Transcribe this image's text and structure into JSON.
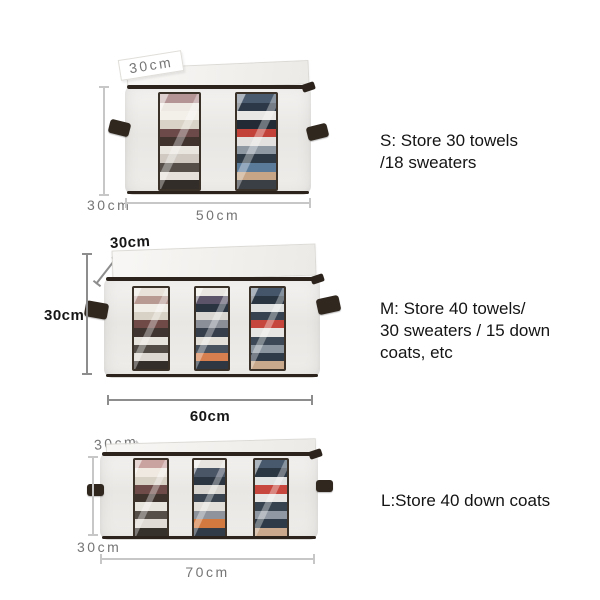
{
  "colors": {
    "canvas_bg": "#ffffff",
    "fabric": "#eceae7",
    "trim": "#2c241c",
    "handle": "#30271f",
    "window_frame": "#3a3128",
    "dim_light": "#c7c7c7",
    "dim_dark": "#8d8d8d",
    "label_gray": "#757575",
    "label_black": "#161616",
    "text": "#141414"
  },
  "products": [
    {
      "size": "S",
      "depth_label": "30cm",
      "height_label": "30cm",
      "width_label": "50cm",
      "description": "S: Store 30 towels\n/18 sweaters"
    },
    {
      "size": "M",
      "depth_label": "30cm",
      "height_label": "30cm",
      "width_label": "60cm",
      "description": "M: Store 40 towels/\n30 sweaters / 15 down\ncoats, etc"
    },
    {
      "size": "L",
      "depth_label": "30cm",
      "height_label": "30cm",
      "width_label": "70cm",
      "description": "L:Store 40 down coats"
    }
  ],
  "stripes": {
    "s1": [
      "#b59495",
      "#efe9e3",
      "#f3efe9",
      "#d9d2c6",
      "#6b4a49",
      "#40332e",
      "#e9e5df",
      "#cfc9c1",
      "#554e48",
      "#e5e0d9",
      "#332d29"
    ],
    "s2": [
      "#4a5a6e",
      "#2c3847",
      "#e8e7e5",
      "#222b35",
      "#c2423a",
      "#e2e1df",
      "#8f99a4",
      "#2e3a46",
      "#5b7b9b",
      "#c5a586",
      "#3a3f46"
    ],
    "m1": [
      "#e8e2da",
      "#b89a93",
      "#f0ece6",
      "#d8d1c5",
      "#6f4a47",
      "#3f3430",
      "#e6e2dc",
      "#524b45",
      "#ddd8d1",
      "#342e2a"
    ],
    "m2": [
      "#e9e6e1",
      "#5c5468",
      "#2a3340",
      "#d9d6d1",
      "#8a8f98",
      "#353e4a",
      "#e3e0da",
      "#47525e",
      "#d77f4f",
      "#2e3742"
    ],
    "m3": [
      "#45566b",
      "#2a3542",
      "#dfe0e0",
      "#36424f",
      "#c6453c",
      "#e6e5e3",
      "#3c4855",
      "#8b959f",
      "#2f3b48",
      "#c9a98b"
    ],
    "l1": [
      "#c9a3a0",
      "#efe9e2",
      "#d8d1c6",
      "#6e4b48",
      "#3e322d",
      "#e8e4de",
      "#564f49",
      "#e0dbd4",
      "#37312c"
    ],
    "l2": [
      "#e8e5e0",
      "#4a5566",
      "#2b3542",
      "#d8d5d0",
      "#39434f",
      "#e2dfda",
      "#8e939c",
      "#d1793f",
      "#313b47"
    ],
    "l3": [
      "#48596d",
      "#2b3643",
      "#e0e1e1",
      "#c7463d",
      "#e7e6e4",
      "#37434f",
      "#9099a3",
      "#2e3a47",
      "#caa98c"
    ]
  }
}
